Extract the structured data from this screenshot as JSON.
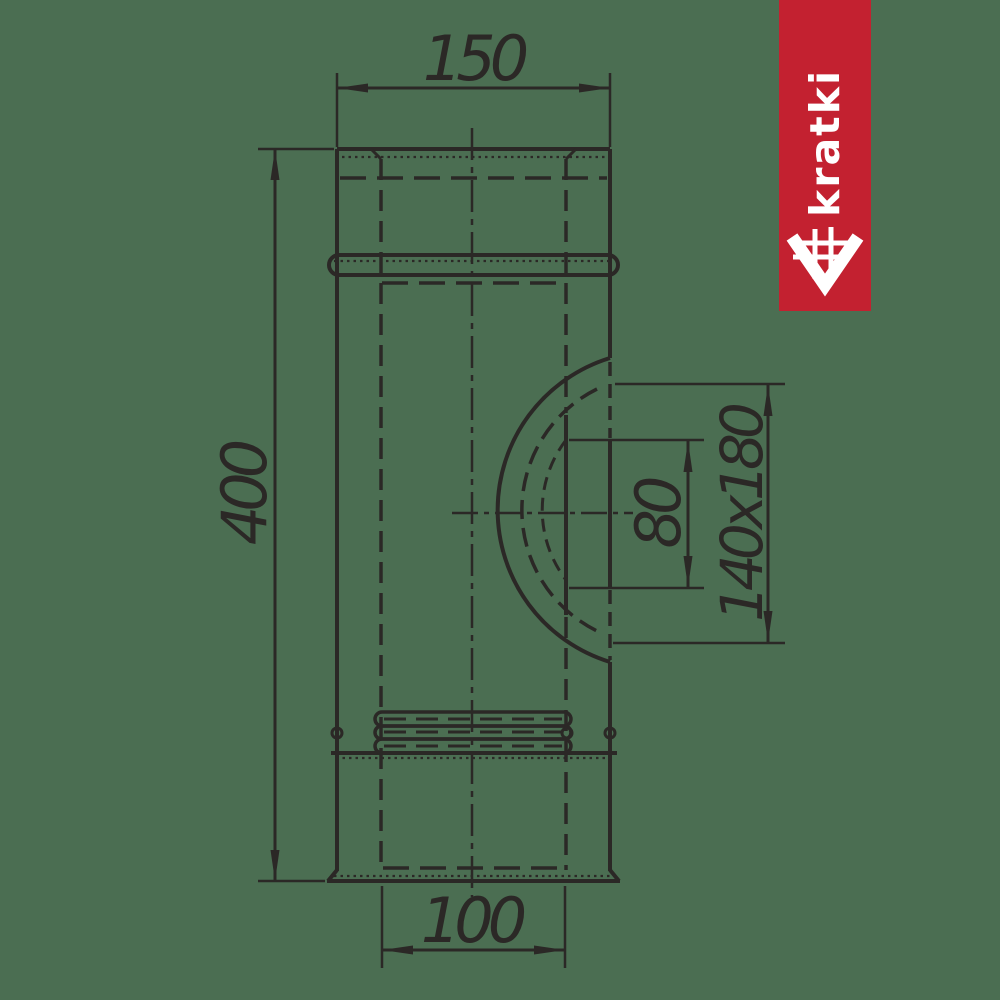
{
  "banner": {
    "brand_text": "kratki",
    "background_color": "#c32130",
    "text_color": "#ffffff",
    "logo_icon": "grate-chevron-icon"
  },
  "drawing": {
    "background_color": "#4b6e52",
    "line_color": "#2b2826",
    "dimensions": {
      "top_outer_width": "150",
      "total_height": "400",
      "outlet_inner_height": "80",
      "outlet_size": "140x180",
      "bottom_inner_width": "100"
    }
  }
}
